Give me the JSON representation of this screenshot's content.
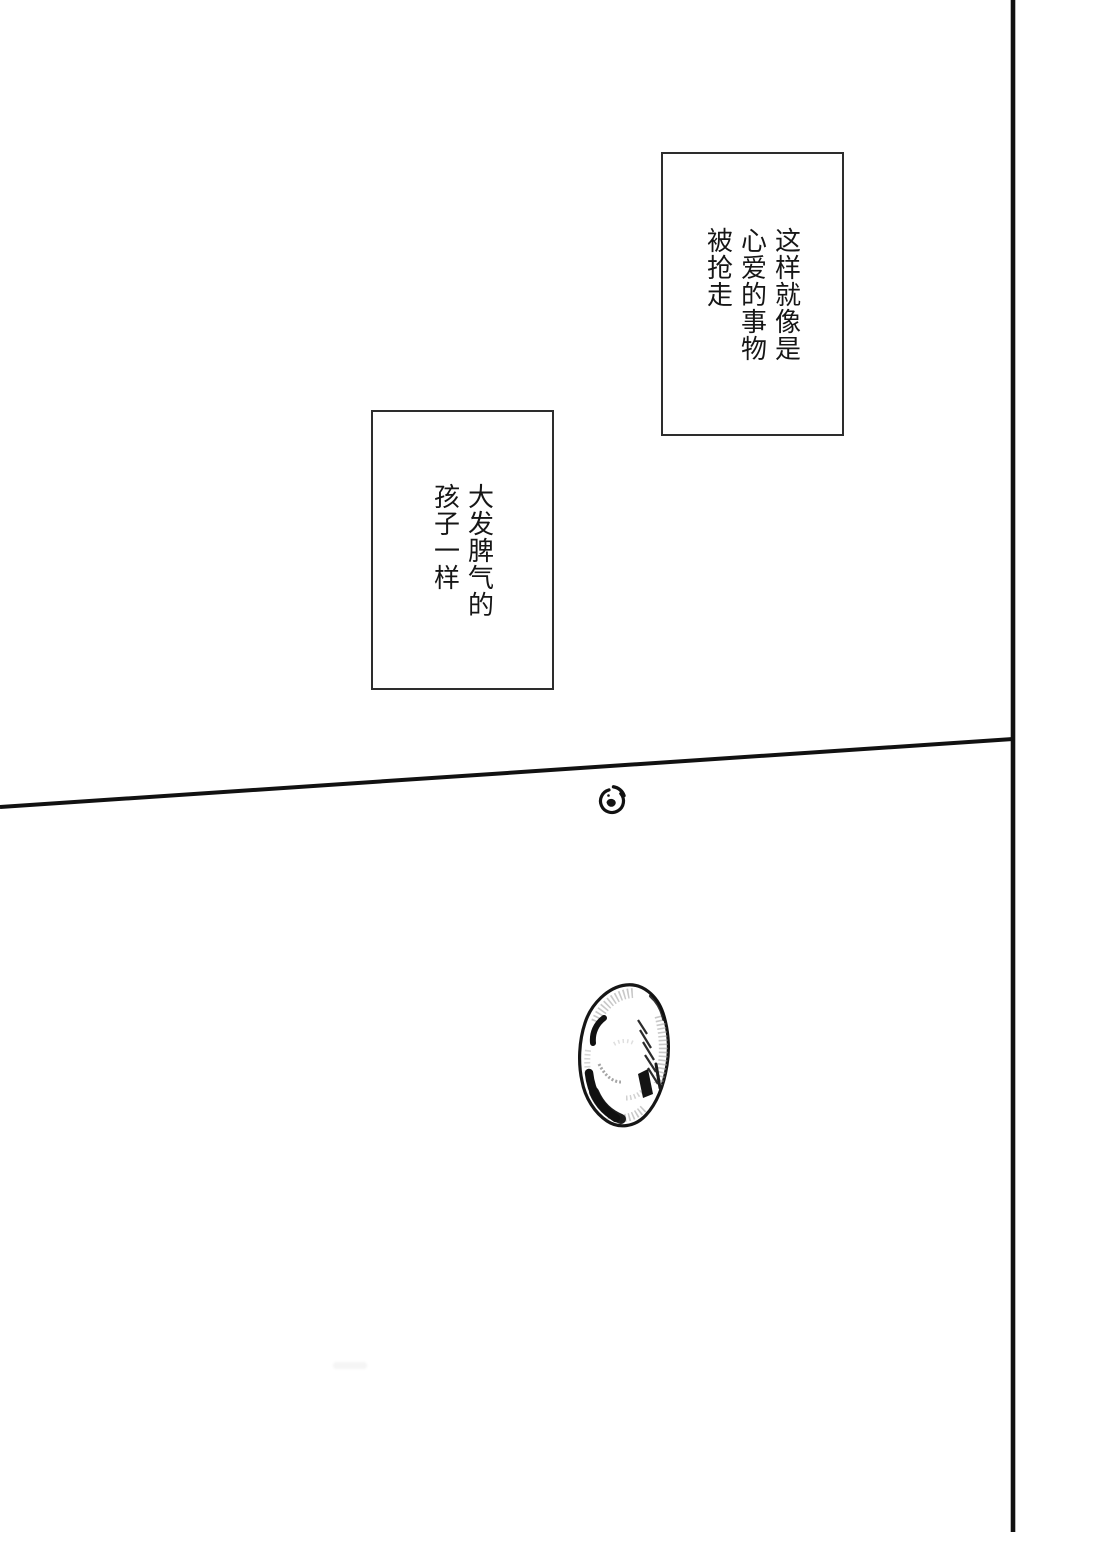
{
  "page": {
    "background_color": "#ffffff",
    "ink_color": "#111111",
    "bubble_border_color": "#2d2d2d",
    "text_color": "#161616"
  },
  "bubbles": {
    "top_right": {
      "text": "这样就像是\n心爱的事物\n被抢走"
    },
    "mid_left": {
      "text": "大发脾气的\n孩子一样"
    }
  },
  "artwork": {
    "spiral_doodle": "curled-spiral-doodle",
    "stone_egg": "shaded-stone-egg"
  }
}
